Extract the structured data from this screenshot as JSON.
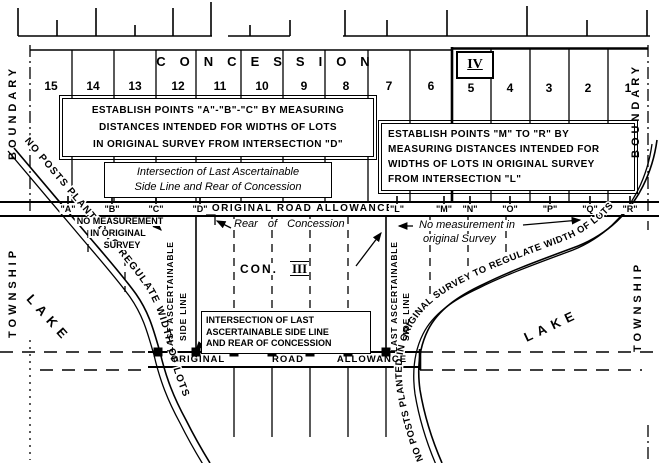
{
  "colors": {
    "ink": "#000000",
    "paper": "#ffffff"
  },
  "top_strip_concession": {
    "label": "CONCESSION",
    "numeral": "IV",
    "lots_left": [
      "15",
      "14",
      "13",
      "12",
      "11",
      "10",
      "9",
      "8",
      "7",
      "6"
    ],
    "lots_right": [
      "5",
      "4",
      "3",
      "2",
      "1"
    ]
  },
  "left_boundary": {
    "township": "TOWNSHIP",
    "boundary": "BOUNDARY"
  },
  "right_boundary": {
    "township": "TOWNSHIP",
    "boundary": "BOUNDARY"
  },
  "note_abc": {
    "line1": "ESTABLISH POINTS \"A\"-\"B\"-\"C\" BY MEASURING",
    "line2": "DISTANCES INTENDED FOR WIDTHS OF LOTS",
    "line3": "IN ORIGINAL SURVEY FROM INTERSECTION \"D\""
  },
  "note_mr": {
    "line1": "ESTABLISH POINTS \"M\" TO \"R\" BY",
    "line2": "MEASURING DISTANCES INTENDED FOR",
    "line3": "WIDTHS OF LOTS IN ORIGINAL SURVEY",
    "line4": "FROM INTERSECTION \"L\""
  },
  "note_intersection_top": [
    "Intersection of Last Ascertainable",
    "Side Line and Rear of Concession"
  ],
  "road_allowance_top": {
    "points_left": [
      "\"A\"",
      "\"B\"",
      "\"C\"",
      "\"D\""
    ],
    "label": "ORIGINAL ROAD ALLOWANCE",
    "points_right": [
      "\"L\"",
      "\"M\"",
      "\"N\"",
      "\"O\"",
      "\"P\"",
      "\"Q\"",
      "\"R\""
    ]
  },
  "middle_concession": {
    "no_measurement_left": [
      "NO MEASUREMENT",
      "IN ORIGINAL",
      "SURVEY"
    ],
    "rear_of_concession": "Rear of Concession",
    "no_measurement_right": [
      "No measurement in",
      "original Survey"
    ],
    "con": "CON.",
    "numeral": "III",
    "side_line_left": [
      "LAST ASCERTAINABLE",
      "SIDE LINE"
    ],
    "side_line_right": [
      "LAST ASCERTAINABLE",
      "SIDE LINE"
    ],
    "lake_left": "LAKE",
    "lake_right": "LAKE",
    "shore_note_left": "NO POSTS PLANTED TO REGULATE WIDTH OF LOTS",
    "shore_note_right": "NO POSTS PLANTED IN ORIGINAL SURVEY TO REGULATE WIDTH OF LOTS"
  },
  "road_allowance_bottom": {
    "words": [
      "ORIGINAL",
      "ROAD",
      "ALLOWANCE"
    ]
  },
  "note_intersection_bottom": [
    "INTERSECTION OF LAST",
    "ASCERTAINABLE SIDE LINE",
    "AND REAR OF CONCESSION"
  ]
}
